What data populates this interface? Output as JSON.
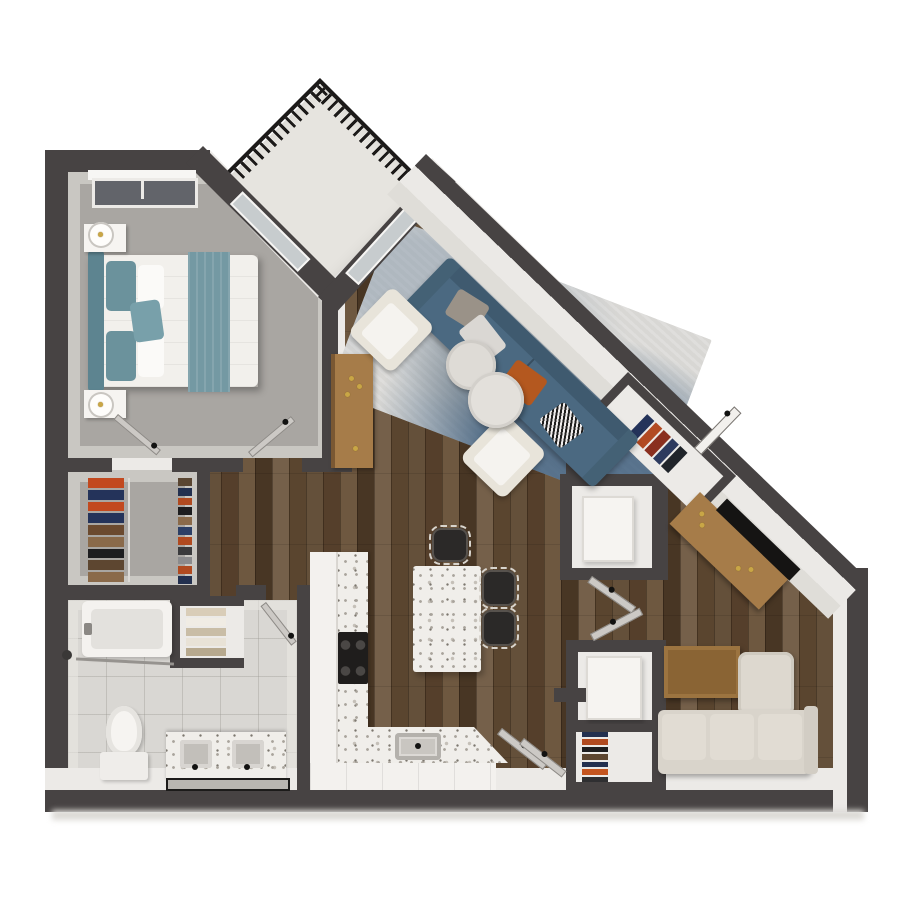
{
  "scene": {
    "type": "isometric-3d-floor-plan",
    "rooms": [
      {
        "id": "bedroom",
        "floor": "gray-carpet"
      },
      {
        "id": "balcony",
        "floor": "concrete"
      },
      {
        "id": "living-dining",
        "floor": "dark-wood-plank"
      },
      {
        "id": "walk-in-closet",
        "floor": "gray-carpet"
      },
      {
        "id": "bathroom",
        "floor": "light-tile"
      },
      {
        "id": "kitchen",
        "floor": "dark-wood-plank"
      },
      {
        "id": "entry-hall",
        "floor": "dark-wood-plank"
      },
      {
        "id": "laundry-closets",
        "floor": "dark-wood-plank"
      },
      {
        "id": "den-office",
        "floor": "dark-wood-plank"
      }
    ],
    "furnishings": {
      "bedroom": [
        "queen-bed-teal-white",
        "headboard",
        "nightstand-left",
        "nightstand-right",
        "lamp",
        "lamp",
        "window"
      ],
      "living": [
        "blue-sofa",
        "armchair",
        "armchair",
        "round-coffee-table",
        "round-coffee-table",
        "area-rug",
        "wood-console"
      ],
      "kitchen": [
        "l-counter-terrazzo",
        "cooktop",
        "sink",
        "island",
        "stool",
        "stool",
        "stool"
      ],
      "bathroom": [
        "bathtub-shower",
        "toilet",
        "double-vanity",
        "mirror",
        "linen-shelves"
      ],
      "closet": [
        "hanging-clothes",
        "shoe-rack"
      ],
      "entry": [
        "coat-closet",
        "entry-door"
      ],
      "laundry": [
        "washer",
        "dryer",
        "stacked-clothes-closet"
      ],
      "den": [
        "wood-desk",
        "tv-panel",
        "sectional-sofa",
        "coffee-table"
      ]
    }
  },
  "palette": {
    "wall": "#474343",
    "face": "#eceae7",
    "carpet": "#a9a6a2",
    "tile": "#d9d7d3",
    "terrazzo": "#f0eeea",
    "balcony": "#e6e4df",
    "railing": "#1c1a19",
    "glass": "#c7ccce",
    "rugbase": "#d8d7d4",
    "sofa": "#4b6981",
    "sofadark": "#3f5a6f",
    "cream": "#e8e4da",
    "sectional": "#d9d4cb",
    "orange": "#b4581f",
    "tealhead": "#5d8490",
    "tealblanket": "#7499a3",
    "duvet": "#f2f0ec",
    "woodfurn": "#a67c49",
    "woodtable": "#8a6434",
    "gold": "#c9a646",
    "black": "#2b2928"
  },
  "stripe_sets": {
    "closet_clothes": [
      "#c2491f",
      "#24335a",
      "#c2491f",
      "#24335a",
      "#6b4a2f",
      "#8a6a4a",
      "#1d1d1f",
      "#5d4630",
      "#8a6a4a"
    ],
    "closet_shoes": [
      "#5a4632",
      "#23304f",
      "#b04a20",
      "#1d1d1f",
      "#8a6a4a",
      "#2c3f66",
      "#b04a20",
      "#3a3a3c",
      "#8b8b8d",
      "#b04a20",
      "#23304f"
    ],
    "entry_coats": [
      "#24335a",
      "#b24a22",
      "#8a2f1f",
      "#2d3a5e",
      "#20242a"
    ],
    "linen_towels": [
      "#d9cdb8",
      "#f0ece4",
      "#c9bda6",
      "#e8e2d6",
      "#b7a98e"
    ],
    "stacked_clothes": [
      "#23304f",
      "#b04a20",
      "#1d1d1f",
      "#5d4630",
      "#23304f",
      "#c4551f",
      "#2f2f31"
    ]
  }
}
